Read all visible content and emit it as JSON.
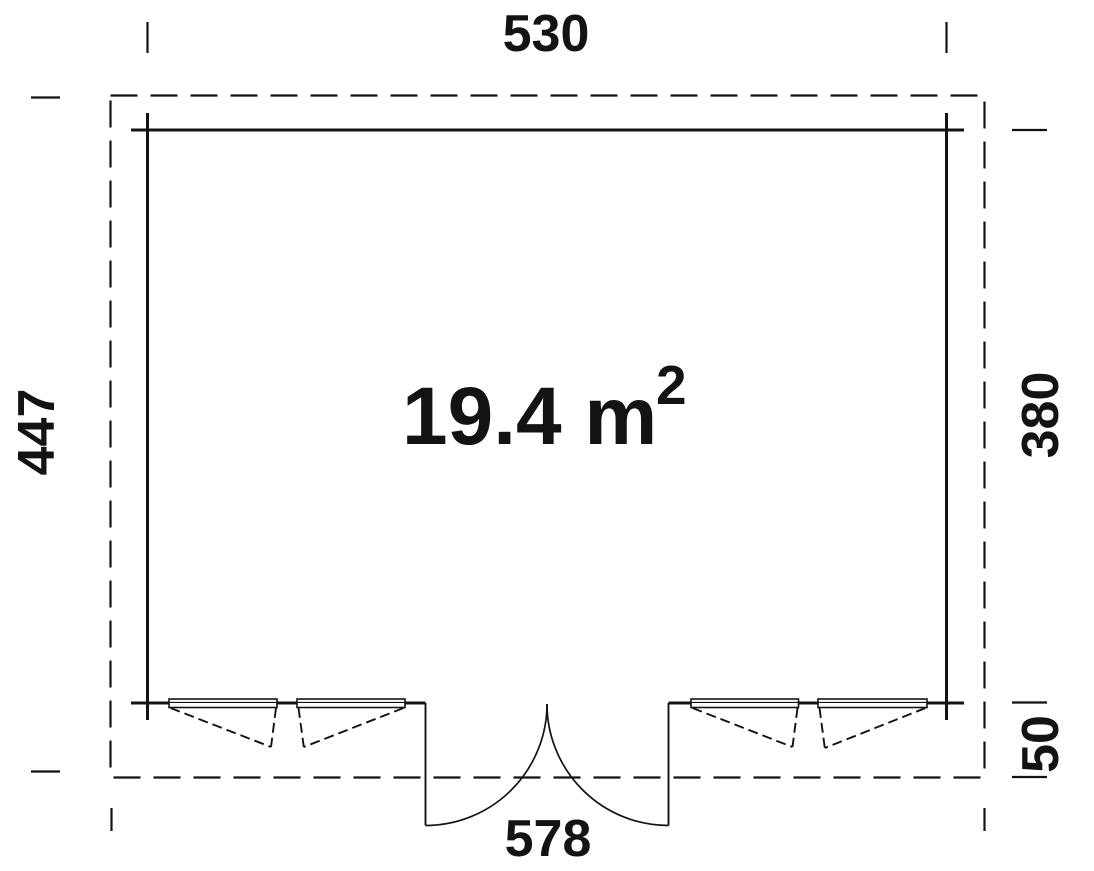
{
  "plan": {
    "type": "floor-plan",
    "area": {
      "base": "19.4 m",
      "sup": "2"
    },
    "dims": {
      "top": "530",
      "left": "447",
      "right": "380",
      "overhang": "50",
      "bottom": "578"
    },
    "colors": {
      "line": "#131313",
      "background": "#ffffff"
    }
  }
}
